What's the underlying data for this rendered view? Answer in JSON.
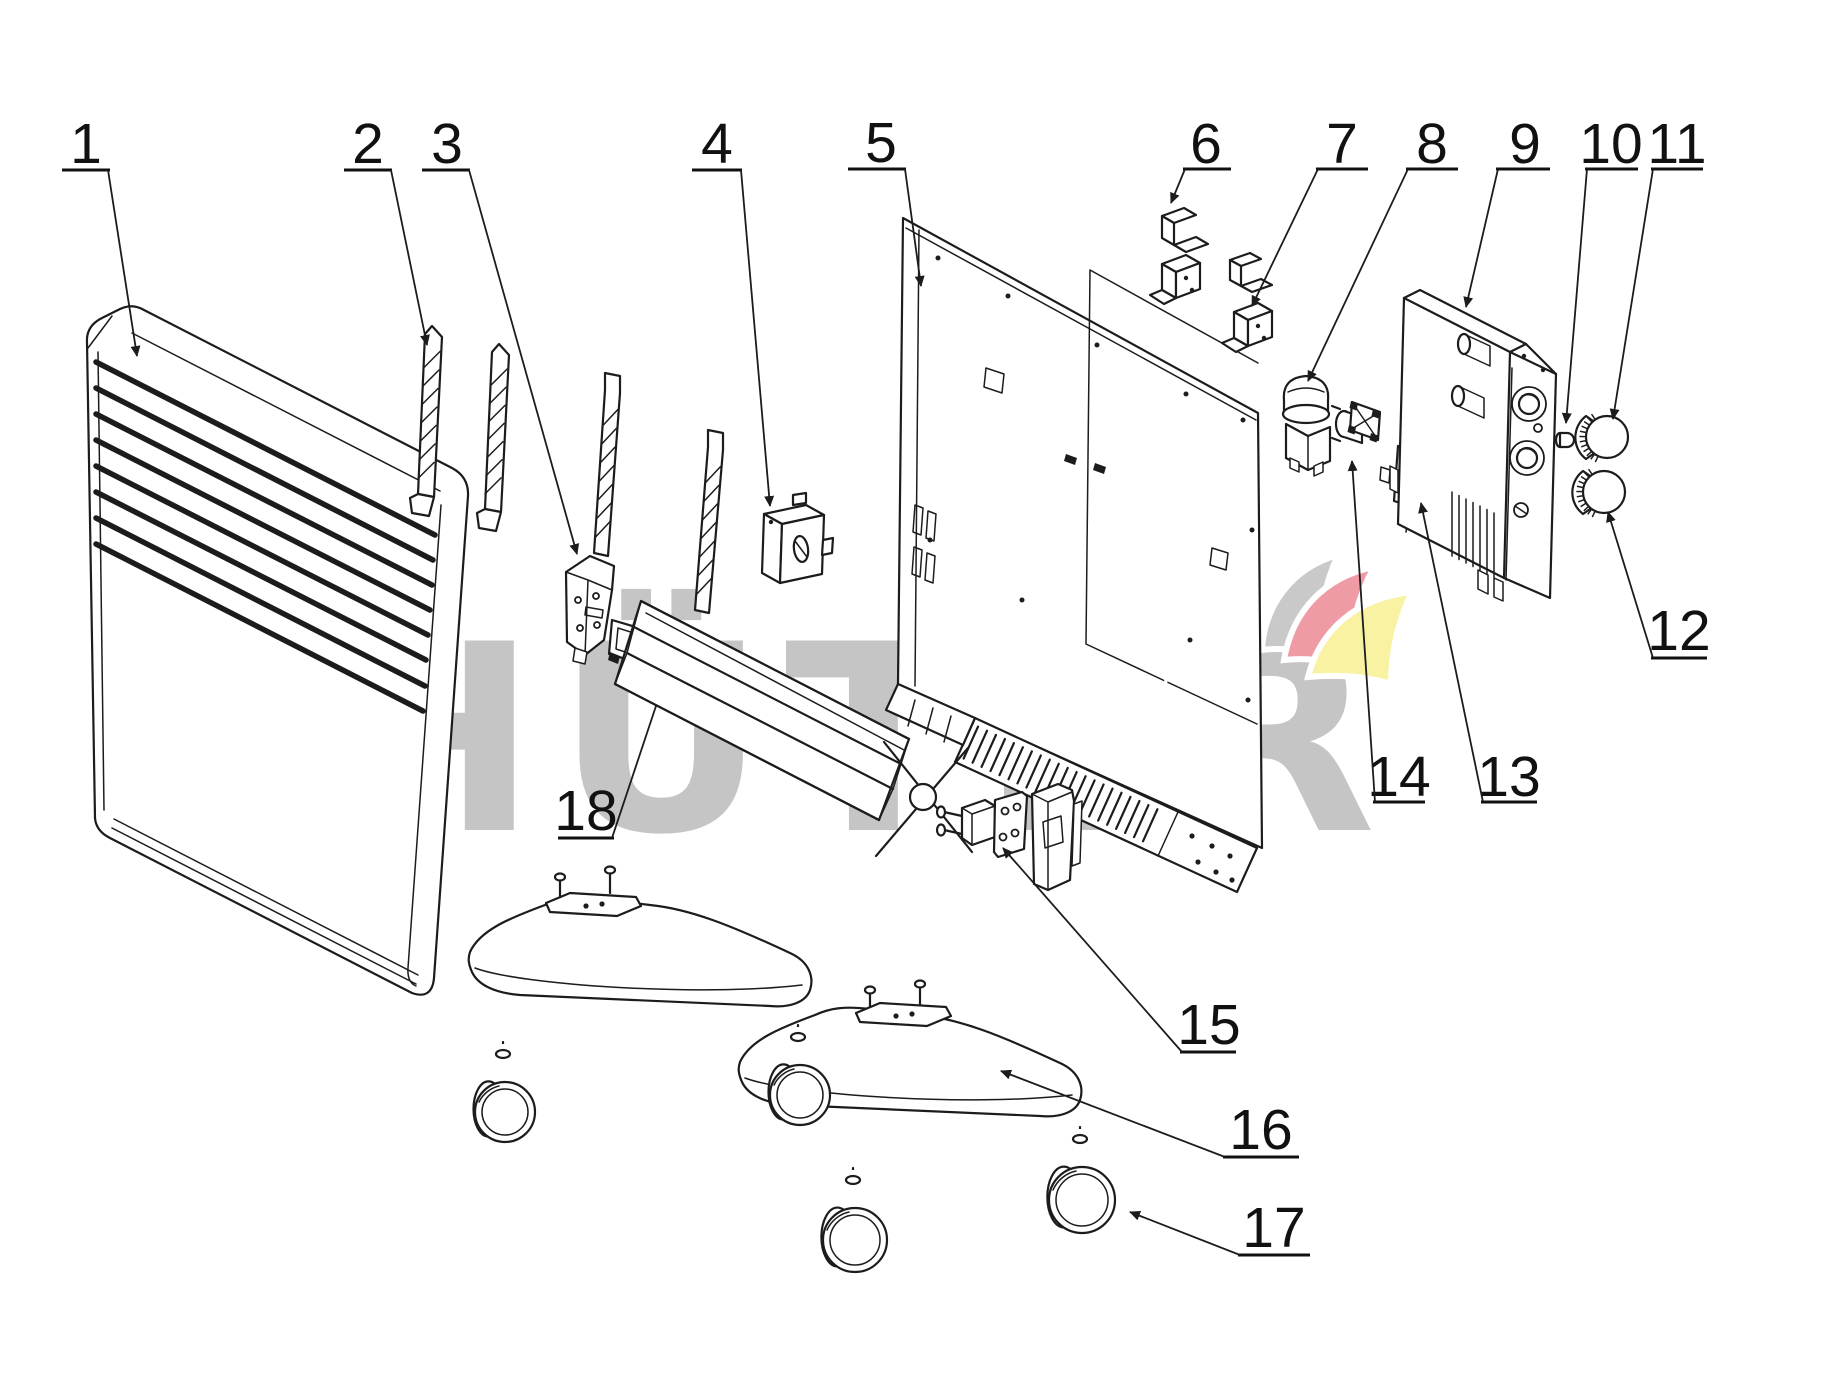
{
  "watermark": {
    "text": "HÜTER",
    "color": "#c5c5c5"
  },
  "logo": {
    "gray": "#c9c9c9",
    "red": "#ee9ba5",
    "yellow": "#f8f2a2"
  },
  "diagram": {
    "line_color": "#1c1c1c",
    "background": "#ffffff"
  },
  "callouts": [
    {
      "number": "1",
      "label_x": 86,
      "label_y": 163,
      "underline": [
        62,
        110,
        170
      ],
      "leader": [
        [
          108,
          170
        ],
        [
          137,
          356
        ]
      ],
      "arrow": true
    },
    {
      "number": "2",
      "label_x": 368,
      "label_y": 163,
      "underline": [
        344,
        392,
        170
      ],
      "leader": [
        [
          391,
          170
        ],
        [
          427,
          345
        ]
      ],
      "arrow": true
    },
    {
      "number": "3",
      "label_x": 447,
      "label_y": 163,
      "underline": [
        422,
        470,
        170
      ],
      "leader": [
        [
          469,
          170
        ],
        [
          577,
          554
        ]
      ],
      "arrow": true
    },
    {
      "number": "4",
      "label_x": 717,
      "label_y": 163,
      "underline": [
        692,
        742,
        170
      ],
      "leader": [
        [
          741,
          170
        ],
        [
          770,
          506
        ]
      ],
      "arrow": true
    },
    {
      "number": "5",
      "label_x": 881,
      "label_y": 162,
      "underline": [
        848,
        906,
        169
      ],
      "leader": [
        [
          905,
          169
        ],
        [
          921,
          286
        ]
      ],
      "arrow": true
    },
    {
      "number": "6",
      "label_x": 1206,
      "label_y": 163,
      "underline": [
        1183,
        1231,
        169
      ],
      "leader": [
        [
          1185,
          169
        ],
        [
          1171,
          203
        ]
      ],
      "arrow": true
    },
    {
      "number": "7",
      "label_x": 1342,
      "label_y": 163,
      "underline": [
        1316,
        1368,
        169
      ],
      "leader": [
        [
          1318,
          169
        ],
        [
          1252,
          306
        ]
      ],
      "arrow": true
    },
    {
      "number": "8",
      "label_x": 1432,
      "label_y": 163,
      "underline": [
        1406,
        1458,
        169
      ],
      "leader": [
        [
          1408,
          169
        ],
        [
          1308,
          381
        ]
      ],
      "arrow": true
    },
    {
      "number": "9",
      "label_x": 1525,
      "label_y": 163,
      "underline": [
        1496,
        1550,
        169
      ],
      "leader": [
        [
          1498,
          169
        ],
        [
          1466,
          307
        ]
      ],
      "arrow": true
    },
    {
      "number": "10",
      "label_x": 1611,
      "label_y": 163,
      "underline": [
        1585,
        1638,
        169
      ],
      "leader": [
        [
          1587,
          169
        ],
        [
          1566,
          423
        ]
      ],
      "arrow": true
    },
    {
      "number": "11",
      "label_x": 1677,
      "label_y": 163,
      "underline": [
        1651,
        1703,
        169
      ],
      "leader": [
        [
          1653,
          169
        ],
        [
          1613,
          419
        ]
      ],
      "arrow": true
    },
    {
      "number": "12",
      "label_x": 1679,
      "label_y": 650,
      "underline": [
        1651,
        1707,
        658
      ],
      "leader": [
        [
          1653,
          658
        ],
        [
          1608,
          512
        ]
      ],
      "arrow": true
    },
    {
      "number": "13",
      "label_x": 1509,
      "label_y": 796,
      "underline": [
        1481,
        1537,
        802
      ],
      "leader": [
        [
          1483,
          802
        ],
        [
          1421,
          503
        ]
      ],
      "arrow": true
    },
    {
      "number": "14",
      "label_x": 1399,
      "label_y": 796,
      "underline": [
        1373,
        1425,
        802
      ],
      "leader": [
        [
          1375,
          802
        ],
        [
          1352,
          461
        ]
      ],
      "arrow": true
    },
    {
      "number": "15",
      "label_x": 1209,
      "label_y": 1044,
      "underline": [
        1180,
        1236,
        1052
      ],
      "leader": [
        [
          1182,
          1052
        ],
        [
          1003,
          848
        ]
      ],
      "arrow": true
    },
    {
      "number": "16",
      "label_x": 1261,
      "label_y": 1149,
      "underline": [
        1223,
        1299,
        1157
      ],
      "leader": [
        [
          1225,
          1157
        ],
        [
          1001,
          1071
        ]
      ],
      "arrow": true
    },
    {
      "number": "17",
      "label_x": 1274,
      "label_y": 1247,
      "underline": [
        1238,
        1310,
        1255
      ],
      "leader": [
        [
          1240,
          1255
        ],
        [
          1130,
          1212
        ]
      ],
      "arrow": true
    },
    {
      "number": "18",
      "label_x": 586,
      "label_y": 830,
      "underline": [
        558,
        614,
        838
      ],
      "leader": [
        [
          612,
          838
        ],
        [
          656,
          706
        ]
      ],
      "arrow": false
    }
  ]
}
